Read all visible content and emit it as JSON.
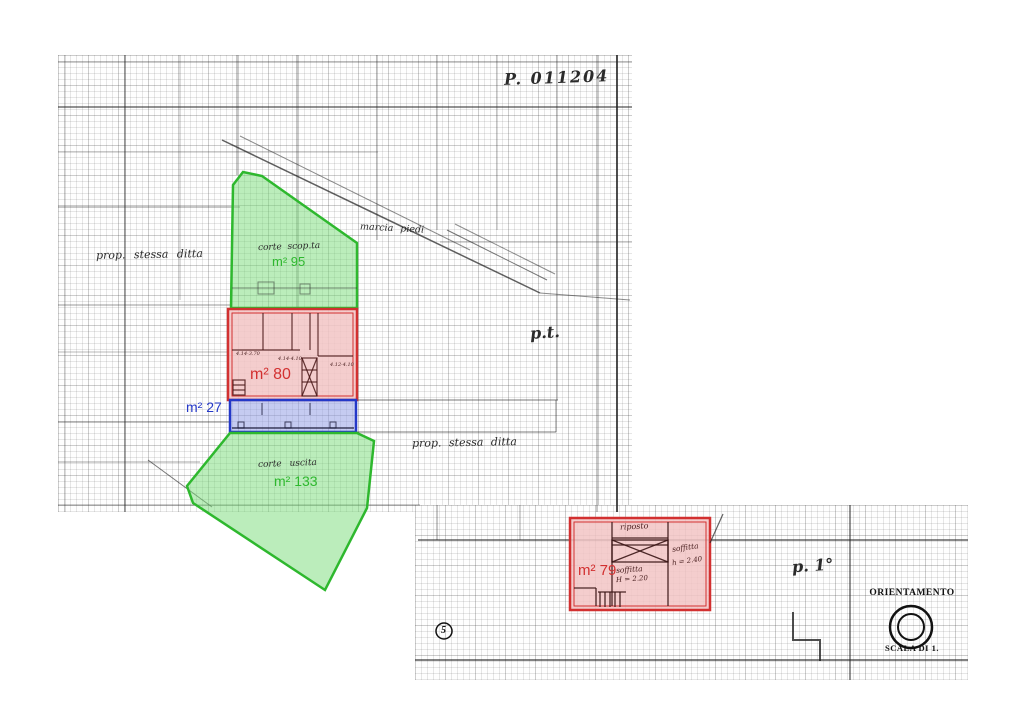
{
  "plan": {
    "protocol": "P. 011204",
    "street_label": "marcia piedi",
    "neighbor_left": "prop. stessa ditta",
    "neighbor_bottom": "prop. stessa ditta",
    "floor_ground_label": "p.t.",
    "floor_first_label": "p. 1°",
    "sheet_number": "5",
    "areas": {
      "courtyard_top": {
        "name": "corte scop.ta",
        "area": "m² 95"
      },
      "building_ground": {
        "area": "m² 80",
        "dims": {
          "left": "4.14·3.70",
          "mid": "4.14·4.10",
          "right": "4.12·4.10"
        }
      },
      "portico": {
        "area": "m² 27"
      },
      "courtyard_bottom": {
        "name": "corte uscita",
        "area": "m² 133"
      },
      "building_first": {
        "area": "m² 79",
        "rooms": {
          "top": "riposto",
          "mid": "soffitta",
          "mid_height": "H = 2.20",
          "right": "soffitta",
          "right_height": "h = 2.40"
        }
      }
    },
    "legend": {
      "orientation_title": "ORIENTAMENTO",
      "scale_label": "SCALA DI 1."
    },
    "colors": {
      "courtyard_green": "#2eb82e",
      "building_red": "#d23030",
      "portico_blue": "#2438c8",
      "ink": "#1a1a1a",
      "paper": "#ffffff"
    }
  }
}
